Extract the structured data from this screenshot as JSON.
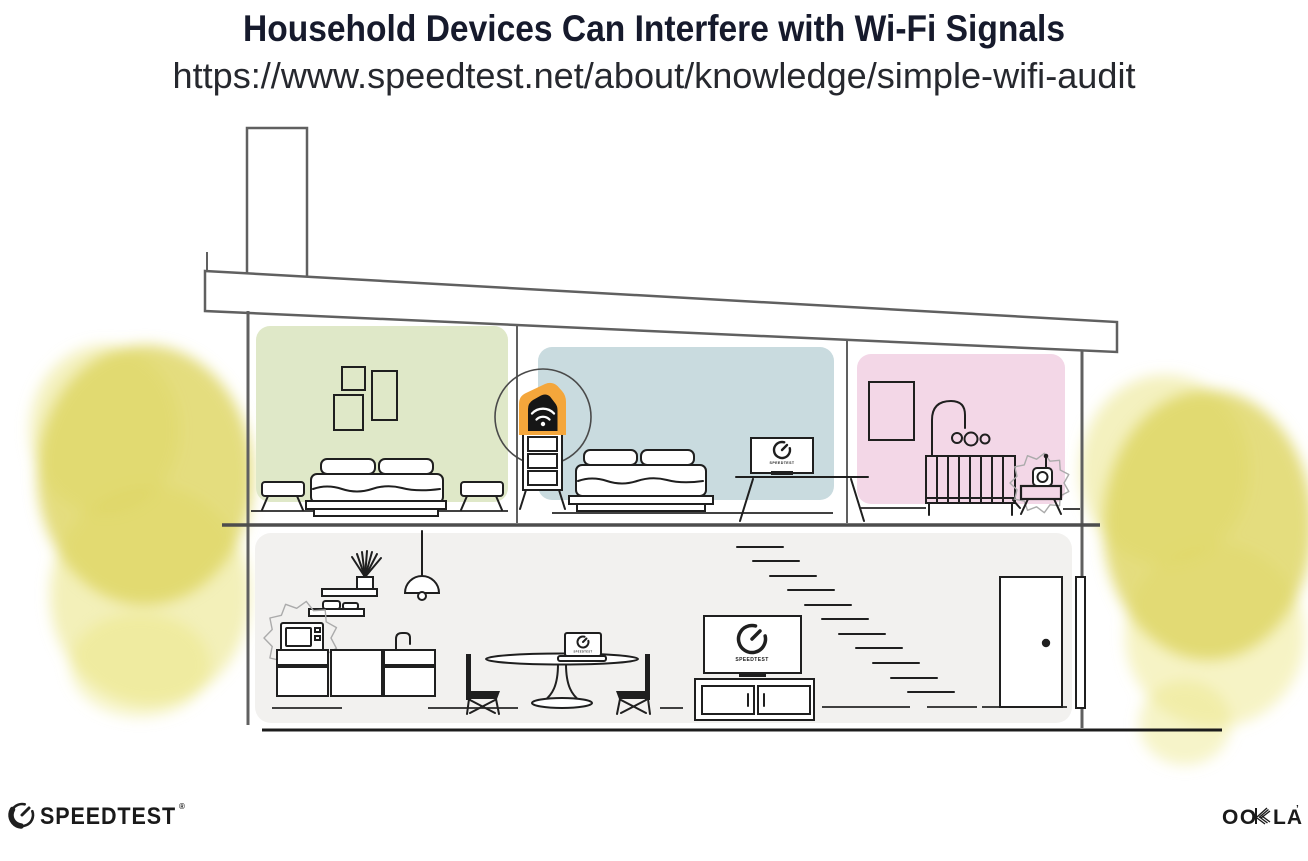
{
  "header": {
    "title": "Household Devices Can Interfere with Wi-Fi Signals",
    "url": "https://www.speedtest.net/about/knowledge/simple-wifi-audit"
  },
  "devices": {
    "screen_brand_label": "SPEEDTEST"
  },
  "footer": {
    "speedtest_wordmark": "SPEEDTEST",
    "speedtest_trademark": "®",
    "ookla_wordmark_left": "OO",
    "ookla_wordmark_right": "LA",
    "ookla_trademark": "’"
  },
  "colors": {
    "title_text": "#161a2c",
    "url_text": "#26282e",
    "line_grey": "#606060",
    "line_dark": "#1f1f1f",
    "room_green": "#dfe8c8",
    "room_blue": "#c9dbdf",
    "room_pink": "#f3d7e7",
    "room_grey": "#f2f1ef",
    "tree_core": "#ddd45f",
    "tree_wash": "#eae47f",
    "accent_orange": "#f4a63b",
    "logo_dark": "#1a1a1a"
  }
}
